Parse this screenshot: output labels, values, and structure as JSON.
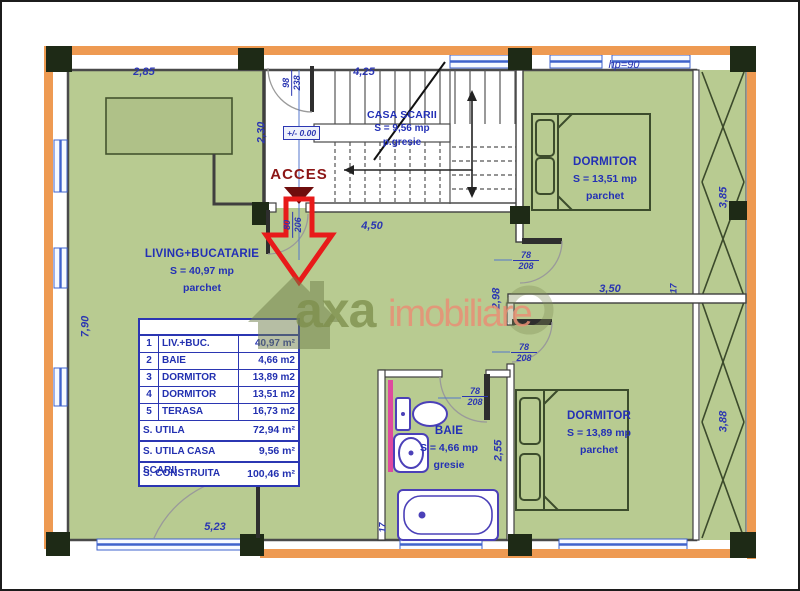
{
  "brand": {
    "logo_left": "axa",
    "logo_right": "imobiliare"
  },
  "plan": {
    "access_label": "ACCES",
    "level_label": "+/- 0.00",
    "rooms": {
      "living": {
        "name": "LIVING+BUCATARIE",
        "area": "S = 40,97 mp",
        "floor": "parchet"
      },
      "stairs": {
        "name": "CASA SCARII",
        "area": "S = 9,56 mp",
        "floor": "p.gresie"
      },
      "bedroom_top": {
        "name": "DORMITOR",
        "area": "S = 13,51 mp",
        "floor": "parchet"
      },
      "bedroom_bottom": {
        "name": "DORMITOR",
        "area": "S = 13,89 mp",
        "floor": "parchet"
      },
      "bathroom": {
        "name": "BAIE",
        "area": "S = 4,66 mp",
        "floor": "gresie"
      }
    },
    "dims": {
      "living_top_width": "2,85",
      "stairs_top_width": "4,25",
      "hall_depth": "2,30",
      "corridor_width": "4,50",
      "living_left_height": "7,90",
      "living_bottom_width": "5,23",
      "mid_wall_length": "3,50",
      "mid_room_height": "2,98",
      "bath_height": "2,55",
      "terrace_top_height": "3,85",
      "terrace_bottom_height": "3,88",
      "window_parapet": "hp=90",
      "wall_thickness_right": "17",
      "wall_thickness_bath": "17",
      "door_entry": {
        "w": "98",
        "h": "238"
      },
      "door_hall": {
        "w": "80",
        "h": "206"
      },
      "door_bedroom_top": {
        "w": "78",
        "h": "208"
      },
      "door_bedroom_bottom": {
        "w": "78",
        "h": "208"
      },
      "door_bathroom": {
        "w": "78",
        "h": "208"
      }
    }
  },
  "area_table": {
    "rows": [
      {
        "num": "1",
        "label": "LIV.+BUC.",
        "value": "40,97 m²"
      },
      {
        "num": "2",
        "label": "BAIE",
        "value": "4,66 m2"
      },
      {
        "num": "3",
        "label": "DORMITOR",
        "value": "13,89 m2"
      },
      {
        "num": "4",
        "label": "DORMITOR",
        "value": "13,51 m2"
      },
      {
        "num": "5",
        "label": "TERASA",
        "value": "16,73 m2"
      }
    ],
    "totals": [
      {
        "label": "S. UTILA",
        "value": "72,94 m²"
      },
      {
        "label": "S. UTILA CASA SCARII",
        "value": "9,56 m²"
      },
      {
        "label": "S. CONSTRUITA",
        "value": "100,46 m²"
      }
    ]
  }
}
